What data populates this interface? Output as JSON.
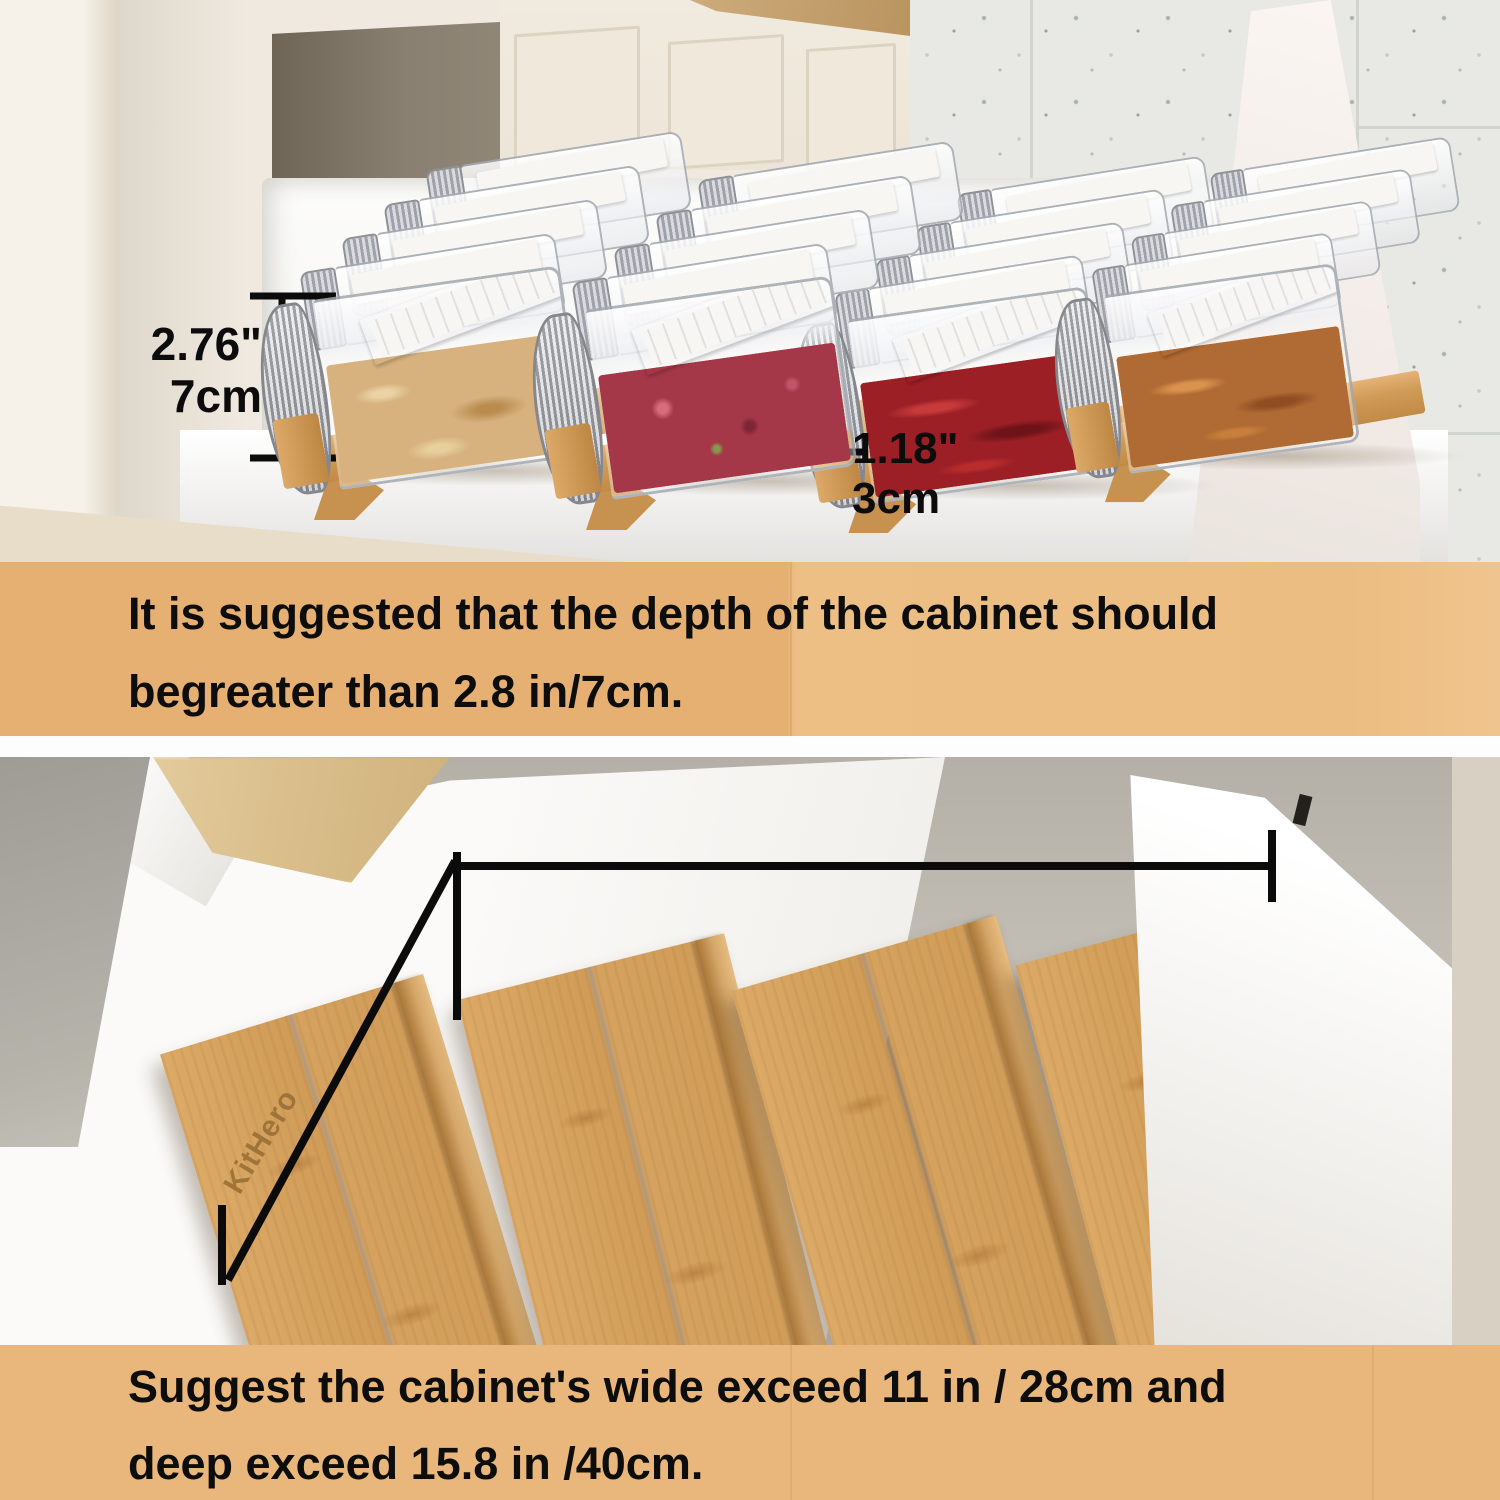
{
  "top_section": {
    "height_label": {
      "inches": "2.76\"",
      "metric": "7cm"
    },
    "riser_label": {
      "inches": "1.18\"",
      "metric": "3cm"
    }
  },
  "note_top": {
    "line1": "It is suggested that the depth of the cabinet should",
    "line2": "begreater than 2.8 in/7cm."
  },
  "bottom_section": {
    "depth_label": "15.8\"/40cm",
    "width_label": {
      "inches": "11\"",
      "metric": "28cm"
    },
    "brand": "KitHero"
  },
  "note_bottom": {
    "line1": "Suggest the cabinet's wide exceed 11 in / 28cm and",
    "line2": "deep exceed 15.8 in /40cm."
  },
  "colors": {
    "note_background": "#e9b77b",
    "bamboo": "#d2a061",
    "annotation_text": "#111111",
    "drawer_white": "#fafaf8"
  }
}
